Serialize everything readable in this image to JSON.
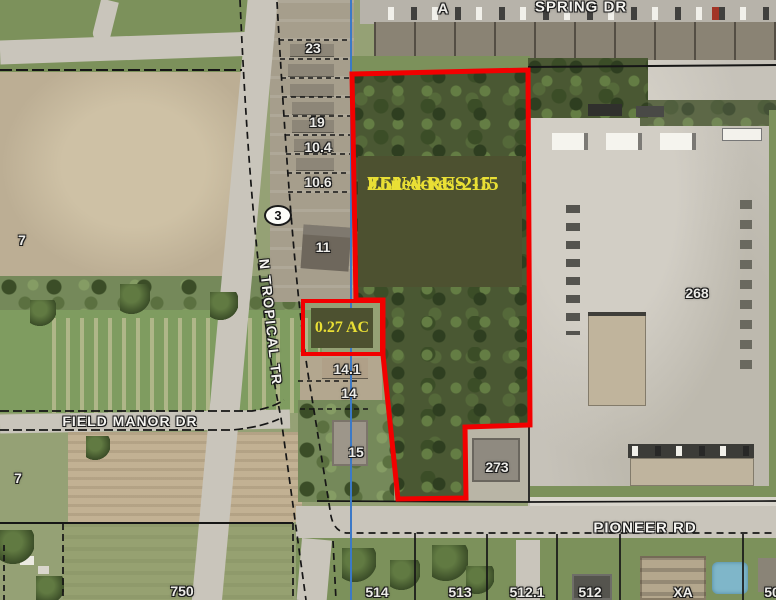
{
  "map": {
    "parcel_annotation": {
      "acreage": "3.52 Acres",
      "zoning": "Zoned RU-2-15",
      "future_land_use": "FLU—RES 15"
    },
    "small_parcel_annotation": {
      "acreage": "0.27 AC"
    },
    "route_marker": {
      "number": "3"
    },
    "building_marker": {
      "label": "A"
    },
    "streets": {
      "spring_dr": "SPRING DR",
      "n_tropical_tr": "N TROPICAL TR",
      "field_manor_dr": "FIELD MANOR DR",
      "pioneer_rd": "PIONEER RD"
    },
    "parcel_labels": [
      {
        "id": "23",
        "text": "23",
        "x": 313,
        "y": 48
      },
      {
        "id": "19",
        "text": "19",
        "x": 317,
        "y": 122
      },
      {
        "id": "10-4",
        "text": "10.4",
        "x": 318,
        "y": 147
      },
      {
        "id": "10-6",
        "text": "10.6",
        "x": 318,
        "y": 182
      },
      {
        "id": "11",
        "text": "11",
        "x": 323,
        "y": 247
      },
      {
        "id": "14-1",
        "text": "14.1",
        "x": 347,
        "y": 369
      },
      {
        "id": "14",
        "text": "14",
        "x": 349,
        "y": 393
      },
      {
        "id": "15",
        "text": "15",
        "x": 356,
        "y": 452
      },
      {
        "id": "273",
        "text": "273",
        "x": 497,
        "y": 467
      },
      {
        "id": "268",
        "text": "268",
        "x": 697,
        "y": 293
      },
      {
        "id": "7-north",
        "text": "7",
        "x": 22,
        "y": 240
      },
      {
        "id": "7-south",
        "text": "7",
        "x": 18,
        "y": 478
      },
      {
        "id": "750",
        "text": "750",
        "x": 182,
        "y": 591
      },
      {
        "id": "514",
        "text": "514",
        "x": 377,
        "y": 592
      },
      {
        "id": "513",
        "text": "513",
        "x": 460,
        "y": 592
      },
      {
        "id": "512-1",
        "text": "512.1",
        "x": 527,
        "y": 592
      },
      {
        "id": "512",
        "text": "512",
        "x": 590,
        "y": 592
      },
      {
        "id": "xa",
        "text": "XA",
        "x": 683,
        "y": 592
      },
      {
        "id": "50",
        "text": "50",
        "x": 772,
        "y": 592
      }
    ],
    "colors": {
      "highlight_outline": "#f20000",
      "annotation_box": "#4d5130",
      "annotation_text": "#e9df35",
      "section_line": "#3b79c7"
    }
  }
}
